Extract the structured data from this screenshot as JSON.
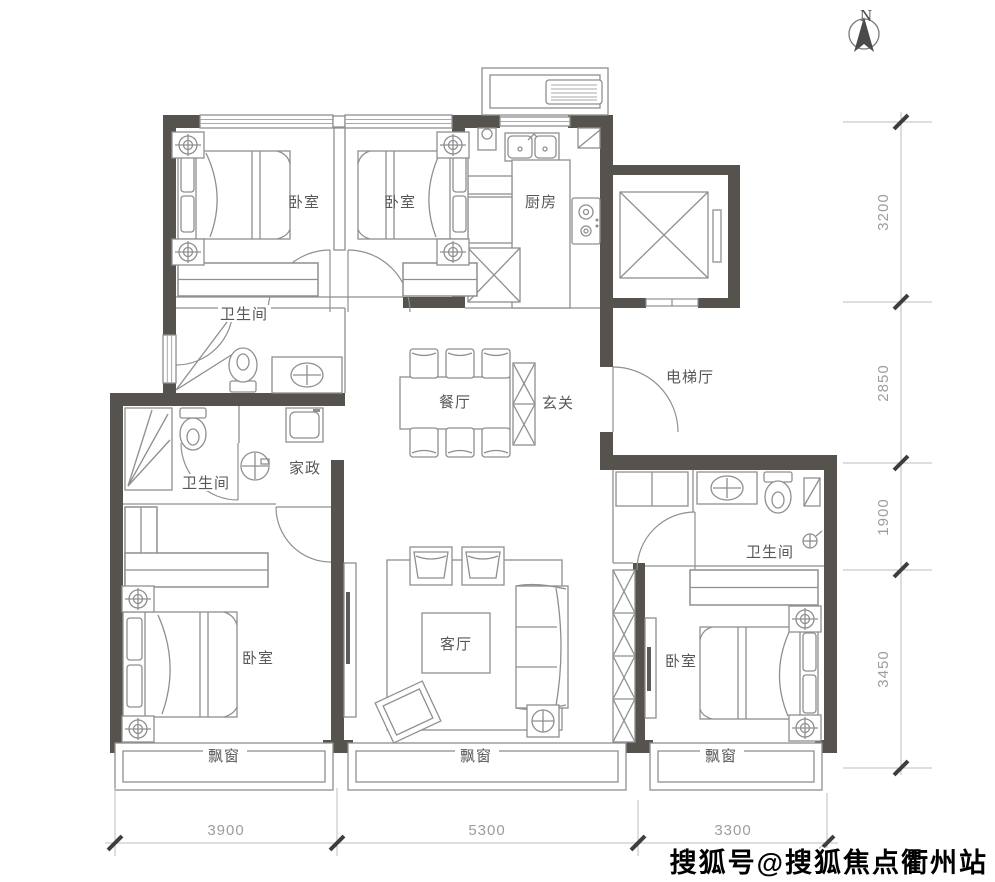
{
  "north_label": "N",
  "rooms": {
    "bedroom_top_left": "卧室",
    "bedroom_top_middle": "卧室",
    "kitchen": "厨房",
    "bath_upper": "卫生间",
    "bath_lower": "卫生间",
    "bath_master": "卫生间",
    "dining": "餐厅",
    "foyer": "玄关",
    "elevator_hall": "电梯厅",
    "housekeeping": "家政",
    "living": "客厅",
    "bedroom_bottom_left": "卧室",
    "bedroom_bottom_right": "卧室",
    "bay_left": "飘窗",
    "bay_middle": "飘窗",
    "bay_right": "飘窗"
  },
  "dimensions": {
    "right": [
      "3200",
      "2850",
      "1900",
      "3450"
    ],
    "bottom": [
      "3900",
      "5300",
      "3300"
    ]
  },
  "watermark": "搜狐号@搜狐焦点衢州站",
  "colors": {
    "wall": "#56524e",
    "line": "#8f8f8f",
    "label": "#595757",
    "dim": "#9d9d9d",
    "tick": "#3e3e3e",
    "watermark": "#000000"
  }
}
